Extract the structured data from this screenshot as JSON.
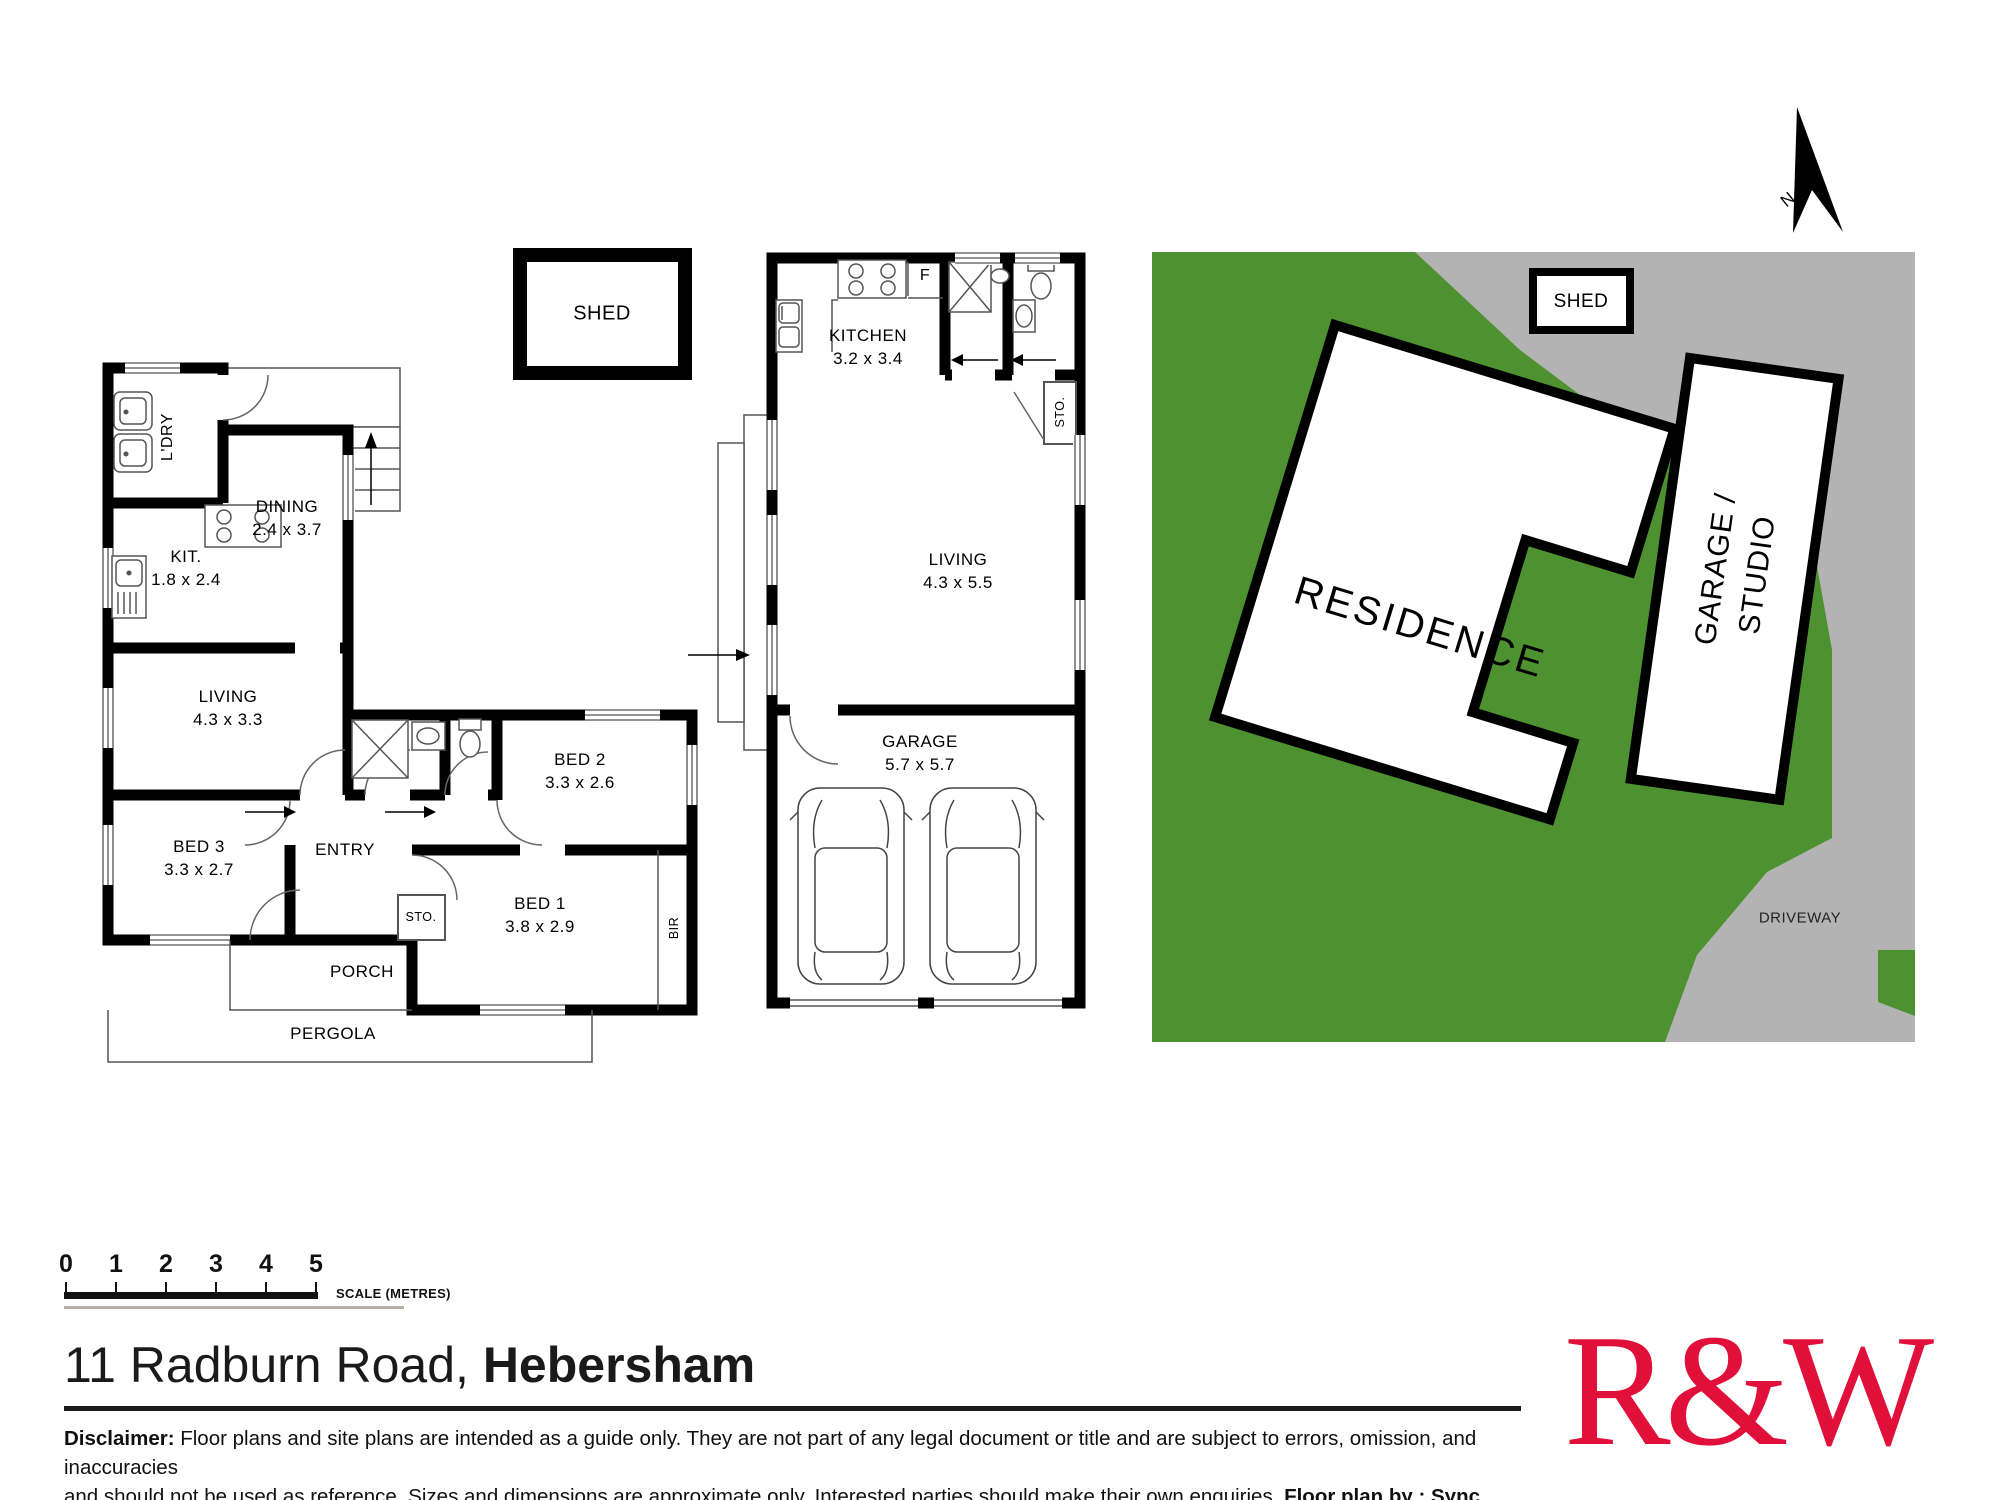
{
  "left_plan": {
    "shed": "SHED",
    "ldry": "L'DRY",
    "dining": {
      "label": "DINING",
      "dims": "2.4 x 3.7"
    },
    "kit": {
      "label": "KIT.",
      "dims": "1.8 x 2.4"
    },
    "living": {
      "label": "LIVING",
      "dims": "4.3 x 3.3"
    },
    "bed3": {
      "label": "BED 3",
      "dims": "3.3 x 2.7"
    },
    "bed2": {
      "label": "BED 2",
      "dims": "3.3 x 2.6"
    },
    "bed1": {
      "label": "BED 1",
      "dims": "3.8 x 2.9"
    },
    "entry": "ENTRY",
    "sto": "STO.",
    "bir": "BIR",
    "porch": "PORCH",
    "pergola": "PERGOLA"
  },
  "middle_plan": {
    "kitchen": {
      "label": "KITCHEN",
      "dims": "3.2 x 3.4"
    },
    "fridge": "F",
    "sto": "STO.",
    "living": {
      "label": "LIVING",
      "dims": "4.3 x 5.5"
    },
    "garage": {
      "label": "GARAGE",
      "dims": "5.7 x 5.7"
    }
  },
  "site_plan": {
    "shed": "SHED",
    "residence": "RESIDENCE",
    "garage_studio_line1": "GARAGE /",
    "garage_studio_line2": "STUDIO",
    "driveway": "DRIVEWAY",
    "north": "N",
    "colors": {
      "grass": "#4d9130",
      "driveway_gray": "#b3b3b3"
    }
  },
  "scale_bar": {
    "ticks": [
      "0",
      "1",
      "2",
      "3",
      "4",
      "5"
    ],
    "caption": "SCALE (METRES)"
  },
  "footer": {
    "address_regular": "11 Radburn Road, ",
    "address_bold": "Hebersham",
    "disclaimer_label": "Disclaimer:",
    "disclaimer_line1": " Floor plans and site plans are intended as a guide only. They are not part of any legal document or title and are subject to errors, omission, and inaccuracies",
    "disclaimer_line2": "and should not be used as reference. Sizes and dimensions are approximate only. Interested parties should make their own enquiries. ",
    "disclaimer_credit": "Floor plan by : Sync Studios Pty Ltd",
    "logo_text": "R&W",
    "logo_color": "#e0103a"
  }
}
